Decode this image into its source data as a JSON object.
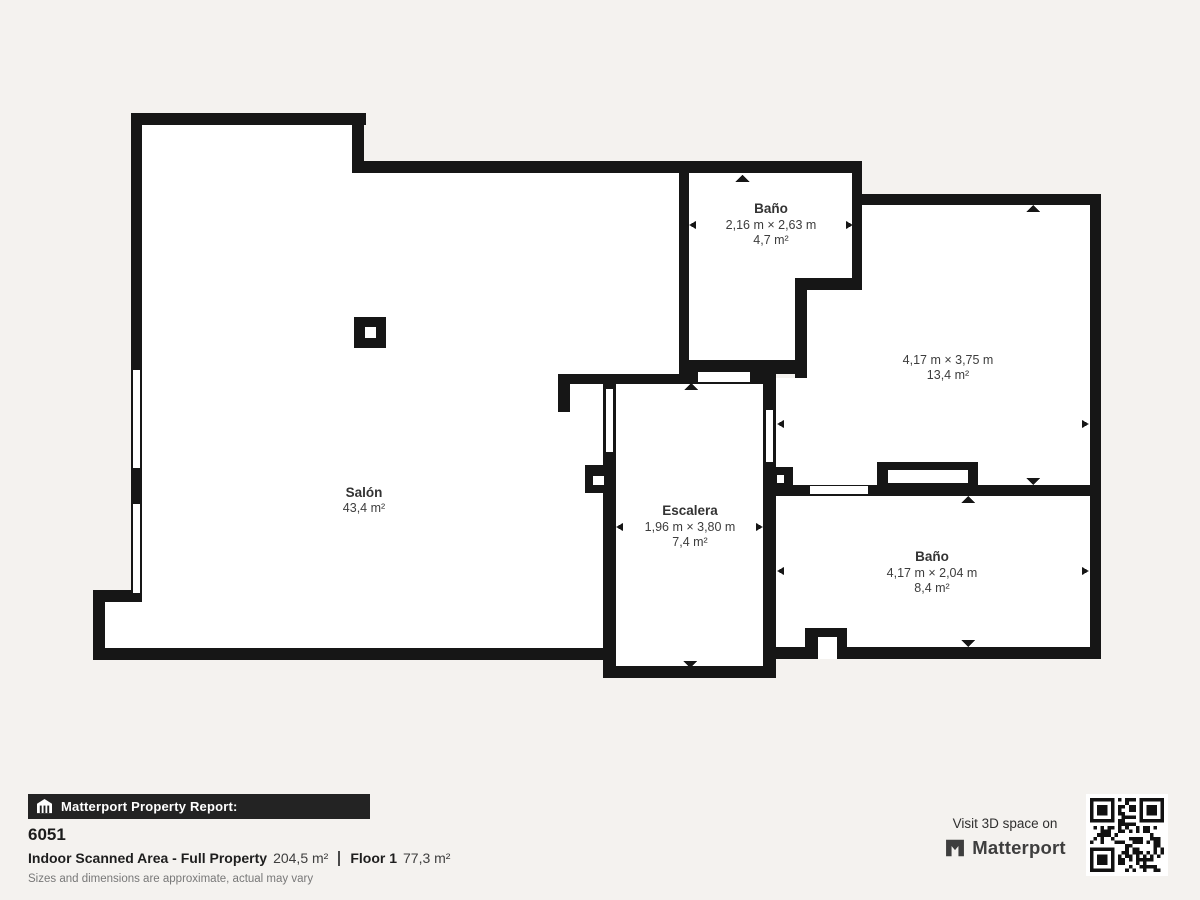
{
  "plan": {
    "rooms": [
      {
        "name": "Baño",
        "dims": "2,16 m × 2,63 m",
        "area": "4,7 m²"
      },
      {
        "dims": "4,17 m × 3,75 m",
        "area": "13,4 m²"
      },
      {
        "name": "Salón",
        "area": "43,4 m²"
      },
      {
        "name": "Escalera",
        "dims": "1,96 m × 3,80 m",
        "area": "7,4 m²"
      },
      {
        "name": "Baño",
        "dims": "4,17 m × 2,04 m",
        "area": "8,4 m²"
      }
    ]
  },
  "footer": {
    "report_bar": "Matterport Property Report:",
    "property_id": "6051",
    "scanned_area_label": "Indoor Scanned Area - Full Property",
    "scanned_area_value": "204,5 m²",
    "floor_label": "Floor 1",
    "floor_value": "77,3 m²",
    "disclaimer": "Sizes and dimensions are approximate, actual may vary",
    "visit_text": "Visit 3D space on",
    "brand": "Matterport"
  },
  "colors": {
    "wall": "#161616",
    "room_fill": "#ffffff",
    "background": "#f4f2ef",
    "bar_background": "#232323"
  }
}
